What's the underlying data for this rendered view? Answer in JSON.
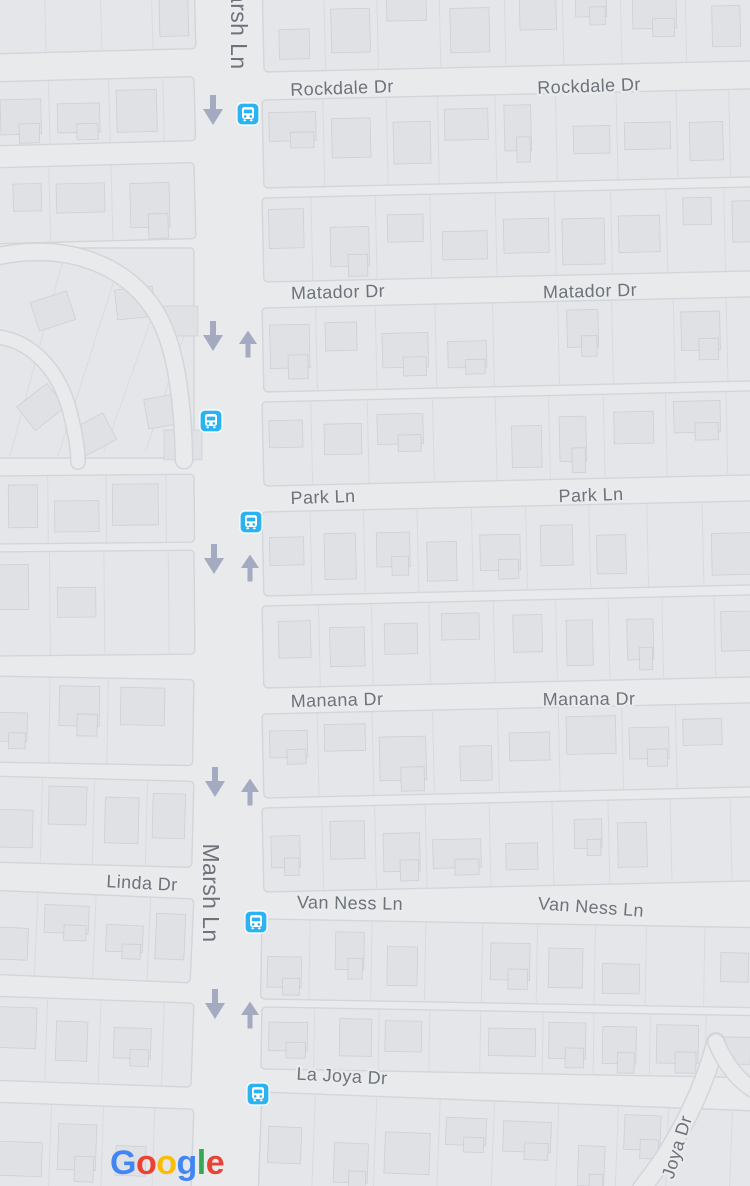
{
  "map": {
    "colors": {
      "road": "#e9eaec",
      "block": "#e5e6e9",
      "block_edge": "#d2d5d9",
      "parcel_line": "#d9dbdf",
      "building": "#dfe1e5",
      "building_edge": "rgba(168,173,182,0.35)",
      "label_text": "#6d727b",
      "label_halo": "#eaebed",
      "transit_blue": "#2bb2f0",
      "arrow": "#a4abc0"
    },
    "street_labels": [
      {
        "name": "marsh-ln-top",
        "text": "Marsh Ln",
        "x": 239,
        "y": 20,
        "rotate": 90,
        "size": 23
      },
      {
        "name": "rockdale-dr-left",
        "text": "Rockdale Dr",
        "x": 342,
        "y": 88,
        "rotate": -2,
        "size": 18
      },
      {
        "name": "rockdale-dr-right",
        "text": "Rockdale Dr",
        "x": 589,
        "y": 86,
        "rotate": -2,
        "size": 18
      },
      {
        "name": "matador-dr-left",
        "text": "Matador Dr",
        "x": 338,
        "y": 292,
        "rotate": -1.5,
        "size": 18
      },
      {
        "name": "matador-dr-right",
        "text": "Matador Dr",
        "x": 590,
        "y": 291,
        "rotate": -1.5,
        "size": 18
      },
      {
        "name": "park-ln-left",
        "text": "Park Ln",
        "x": 323,
        "y": 497,
        "rotate": -2,
        "size": 18
      },
      {
        "name": "park-ln-right",
        "text": "Park Ln",
        "x": 591,
        "y": 495,
        "rotate": -2,
        "size": 18
      },
      {
        "name": "manana-dr-left",
        "text": "Manana Dr",
        "x": 337,
        "y": 700,
        "rotate": -1.5,
        "size": 18
      },
      {
        "name": "manana-dr-right",
        "text": "Manana Dr",
        "x": 589,
        "y": 699,
        "rotate": -0.5,
        "size": 18
      },
      {
        "name": "linda-dr",
        "text": "Linda Dr",
        "x": 142,
        "y": 883,
        "rotate": 3,
        "size": 18
      },
      {
        "name": "marsh-ln",
        "text": "Marsh Ln",
        "x": 211,
        "y": 893,
        "rotate": 90,
        "size": 23
      },
      {
        "name": "van-ness-ln-left",
        "text": "Van Ness Ln",
        "x": 350,
        "y": 903,
        "rotate": 1,
        "size": 18
      },
      {
        "name": "van-ness-ln-right",
        "text": "Van Ness Ln",
        "x": 591,
        "y": 907,
        "rotate": 4,
        "size": 18
      },
      {
        "name": "la-joya-dr",
        "text": "La Joya Dr",
        "x": 342,
        "y": 1076,
        "rotate": 3,
        "size": 18
      },
      {
        "name": "joya-dr-diagonal",
        "text": "Joya Dr",
        "x": 677,
        "y": 1147,
        "rotate": -73,
        "size": 18
      }
    ],
    "bus_stops": [
      {
        "x": 248,
        "y": 114
      },
      {
        "x": 211,
        "y": 421
      },
      {
        "x": 251,
        "y": 522
      },
      {
        "x": 256,
        "y": 922
      },
      {
        "x": 258,
        "y": 1094
      }
    ],
    "arrows_down": [
      {
        "x": 213,
        "y": 110
      },
      {
        "x": 213,
        "y": 336
      },
      {
        "x": 214,
        "y": 559
      },
      {
        "x": 215,
        "y": 782
      },
      {
        "x": 215,
        "y": 1004
      }
    ],
    "arrows_up": [
      {
        "x": 248,
        "y": 344
      },
      {
        "x": 250,
        "y": 568
      },
      {
        "x": 250,
        "y": 792
      },
      {
        "x": 250,
        "y": 1015
      }
    ],
    "attribution": {
      "text": "Google",
      "letters": [
        {
          "ch": "G",
          "color": "#4285F4"
        },
        {
          "ch": "o",
          "color": "#EA4335"
        },
        {
          "ch": "o",
          "color": "#FBBC05"
        },
        {
          "ch": "g",
          "color": "#4285F4"
        },
        {
          "ch": "l",
          "color": "#34A853"
        },
        {
          "ch": "e",
          "color": "#EA4335"
        }
      ],
      "x": 110,
      "y": 1174,
      "size": 34
    }
  }
}
